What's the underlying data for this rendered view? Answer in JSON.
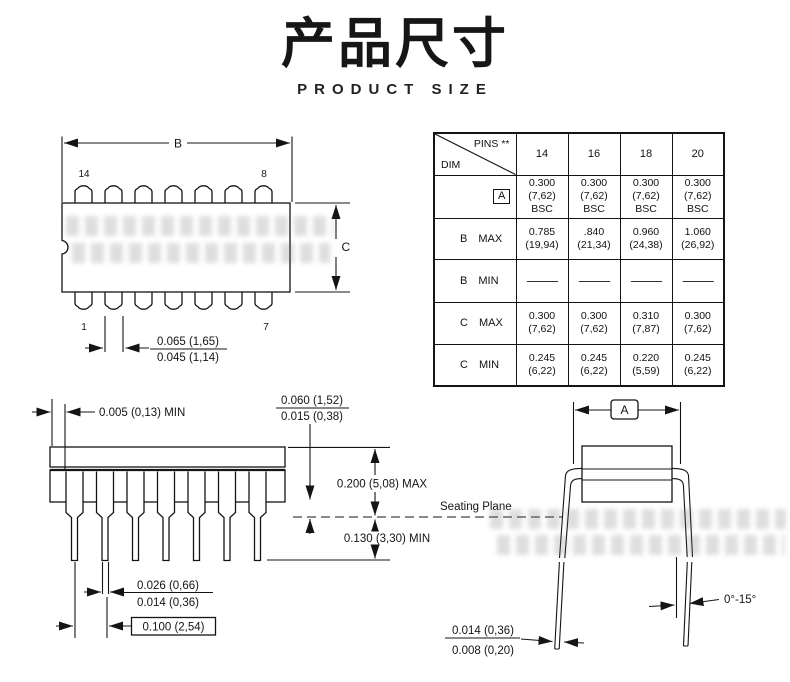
{
  "page": {
    "title_cn": "产品尺寸",
    "title_en": "PRODUCT SIZE"
  },
  "top_view": {
    "dim_b": "B",
    "dim_c": "C",
    "pin_14": "14",
    "pin_8": "8",
    "pin_1": "1",
    "pin_7": "7",
    "lead_w_max": "0.065 (1,65)",
    "lead_w_min": "0.045 (1,14)"
  },
  "table": {
    "corner_pins": "PINS **",
    "corner_dim": "DIM",
    "columns": [
      "14",
      "16",
      "18",
      "20"
    ],
    "rows": [
      {
        "dim": "A",
        "qual": "",
        "cells": [
          [
            "0.300",
            "(7,62)",
            "BSC"
          ],
          [
            "0.300",
            "(7,62)",
            "BSC"
          ],
          [
            "0.300",
            "(7,62)",
            "BSC"
          ],
          [
            "0.300",
            "(7,62)",
            "BSC"
          ]
        ]
      },
      {
        "dim": "B",
        "qual": "MAX",
        "cells": [
          [
            "0.785",
            "(19,94)"
          ],
          [
            ".840",
            "(21,34)"
          ],
          [
            "0.960",
            "(24,38)"
          ],
          [
            "1.060",
            "(26,92)"
          ]
        ]
      },
      {
        "dim": "B",
        "qual": "MIN",
        "cells": [
          [
            "—"
          ],
          [
            "—"
          ],
          [
            "—"
          ],
          [
            "—"
          ]
        ]
      },
      {
        "dim": "C",
        "qual": "MAX",
        "cells": [
          [
            "0.300",
            "(7,62)"
          ],
          [
            "0.300",
            "(7,62)"
          ],
          [
            "0.310",
            "(7,87)"
          ],
          [
            "0.300",
            "(7,62)"
          ]
        ]
      },
      {
        "dim": "C",
        "qual": "MIN",
        "cells": [
          [
            "0.245",
            "(6,22)"
          ],
          [
            "0.245",
            "(6,22)"
          ],
          [
            "0.220",
            "(5,59)"
          ],
          [
            "0.245",
            "(6,22)"
          ]
        ]
      }
    ]
  },
  "side_view": {
    "edge_gap": "0.005 (0,13) MIN",
    "standoff_max": "0.060 (1,52)",
    "standoff_min": "0.015 (0,38)",
    "body_height": "0.200 (5,08) MAX",
    "seating_plane": "Seating Plane",
    "lead_below": "0.130 (3,30) MIN",
    "lead_w_max": "0.026 (0,66)",
    "lead_w_min": "0.014 (0,36)",
    "pitch": "0.100 (2,54)"
  },
  "end_view": {
    "dim_a": "A",
    "angle": "0°-15°",
    "lead_t_max": "0.014 (0,36)",
    "lead_t_min": "0.008 (0,20)"
  }
}
